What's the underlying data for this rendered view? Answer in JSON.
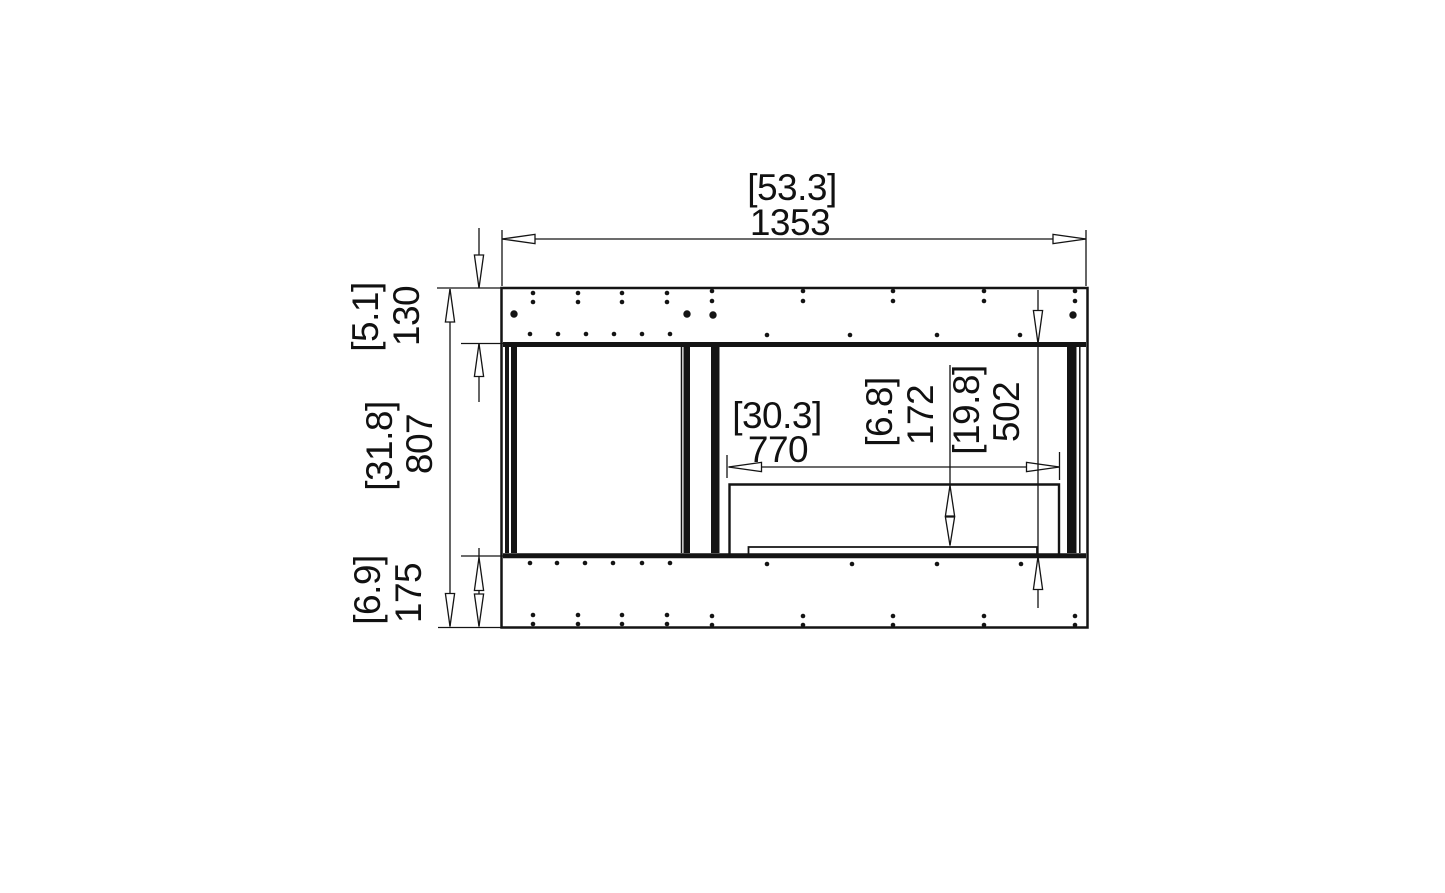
{
  "drawing": {
    "description": "Fireplace firebox framing dimension diagram, front view",
    "line_color": "#141414",
    "background": "#ffffff",
    "dims": {
      "overall_width": {
        "in": "[53.3]",
        "mm": "1353"
      },
      "header_height": {
        "in": "[5.1]",
        "mm": "130"
      },
      "middle_height": {
        "in": "[31.8]",
        "mm": "807"
      },
      "base_height": {
        "in": "[6.9]",
        "mm": "175"
      },
      "opening_width": {
        "in": "[30.3]",
        "mm": "770"
      },
      "inner_height": {
        "in": "[6.8]",
        "mm": "172"
      },
      "cavity_height": {
        "in": "[19.8]",
        "mm": "502"
      }
    }
  }
}
